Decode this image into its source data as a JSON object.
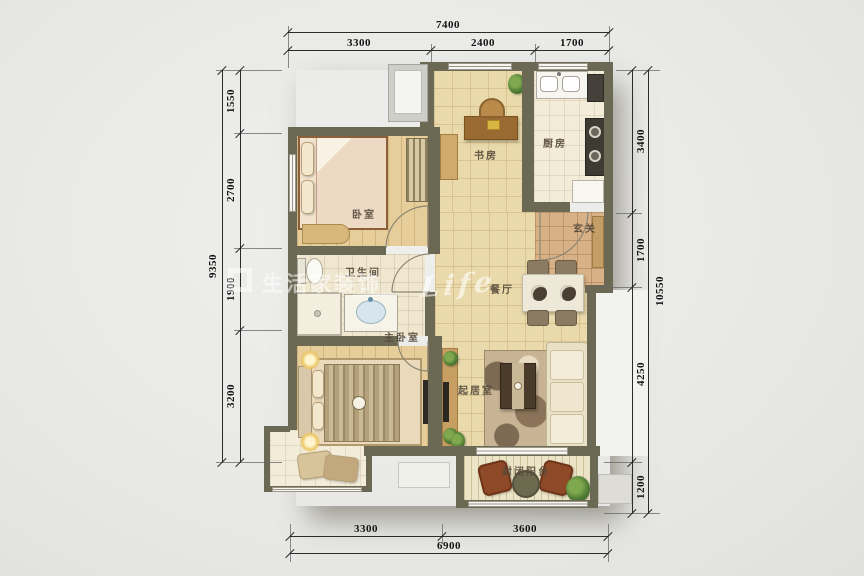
{
  "colors": {
    "wall": "#6b6854",
    "tile": "#e9d9ab",
    "wood": "#e6cd99",
    "dim_text": "#141414",
    "label_text": "#55493a",
    "chair_red": "#8e4a28",
    "furniture_brown": "#9a6a33"
  },
  "plan": {
    "labels": {
      "study": "书房",
      "kitchen": "厨房",
      "foyer": "玄关",
      "bedroom": "卧室",
      "bathroom": "卫生间",
      "dining": "餐厅",
      "master": "主卧室",
      "living": "起居室",
      "balcony": "封闭阳台"
    },
    "dims": {
      "top": {
        "total": "7400",
        "segs": [
          "3300",
          "2400",
          "1700"
        ]
      },
      "left": {
        "total": "9350",
        "segs": [
          "1550",
          "2700",
          "1900",
          "3200"
        ]
      },
      "right": {
        "total": "10550",
        "segs": [
          "3400",
          "1700",
          "4250",
          "1200"
        ]
      },
      "bottom": {
        "total": "6900",
        "segs": [
          "3300",
          "3600"
        ]
      }
    },
    "watermark": {
      "cn": "生活家装饰",
      "script": "Life"
    }
  }
}
